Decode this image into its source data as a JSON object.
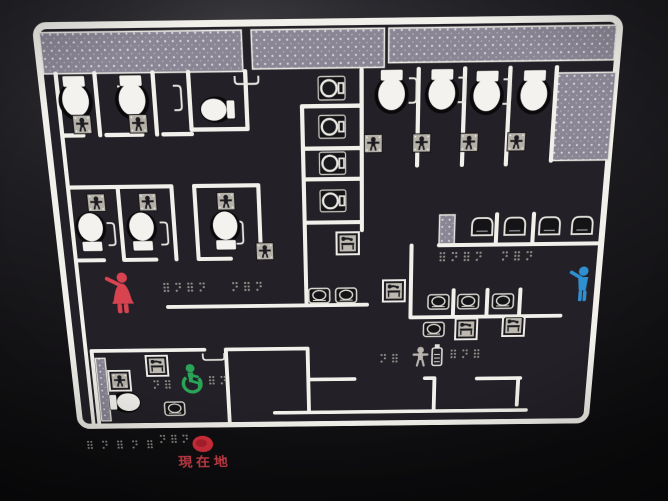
{
  "sign": {
    "you_are_here_label": "現在地",
    "markers": {
      "female_figure_color": "#d84350",
      "male_figure_color": "#2f8fd0",
      "accessible_figure_color": "#2aa558",
      "you_are_here_dot_color": "#d92f3d",
      "you_are_here_text_color": "#d8414b"
    },
    "palette": {
      "panel_black": "#232127",
      "wall_white": "#f2f0ea",
      "hatch_gray": "#8b8694",
      "fixture_white": "#f3f2ee",
      "tag_gray": "#b5b1a9",
      "braille_dot_gray": "#8f8c86"
    },
    "fixtures": {
      "western_toilets": 10,
      "squat_toilets": 4,
      "urinals": 4,
      "wash_basins": 8,
      "baby_seat_tags": 10,
      "diaper_change_stations": 5,
      "nursing_station": 1,
      "accessible_room": 1
    },
    "braille_cluster_count": 10
  }
}
